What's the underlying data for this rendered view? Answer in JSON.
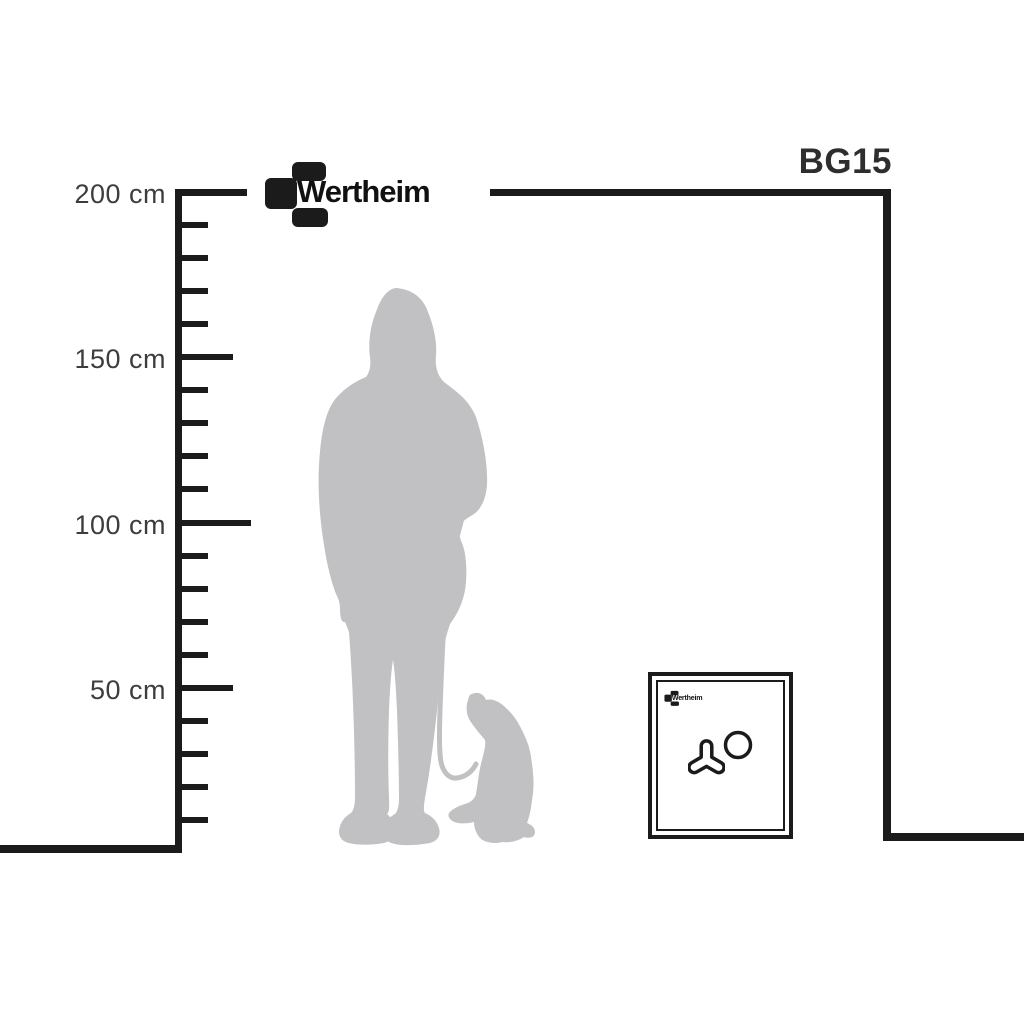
{
  "model_label": "BG15",
  "brand": {
    "name": "Wertheim"
  },
  "ruler": {
    "unit": "cm",
    "max_cm": 200,
    "min_cm": 0,
    "tick_step_cm": 10,
    "labels": [
      {
        "cm": 200,
        "text": "200 cm"
      },
      {
        "cm": 150,
        "text": "150 cm"
      },
      {
        "cm": 100,
        "text": "100 cm"
      },
      {
        "cm": 50,
        "text": "50 cm"
      }
    ]
  },
  "safe": {
    "logo_text": "Wertheim"
  },
  "figures": {
    "person_icon": "woman-silhouette",
    "dog_icon": "sitting-dog-silhouette",
    "leash_icon": "leash"
  },
  "colors": {
    "line": "#1b1b1b",
    "label_text": "#3d3d3d",
    "silhouette": "#c1c1c3",
    "background": "#ffffff"
  }
}
